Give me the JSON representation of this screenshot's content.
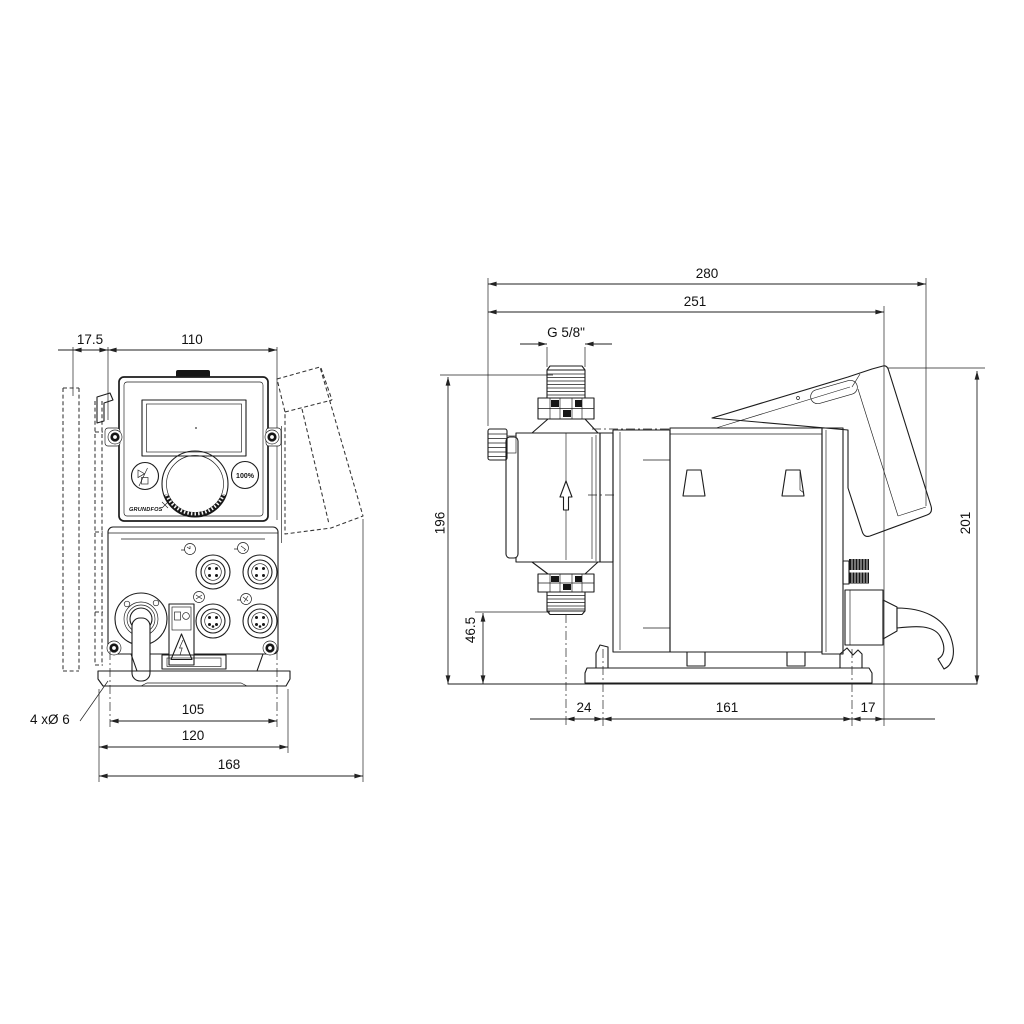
{
  "drawing": {
    "front_view": {
      "dim_offset": "17.5",
      "dim_width": "110",
      "dim_hole_spacing": "105",
      "dim_plate_width": "120",
      "dim_overall_width": "168",
      "mounting_holes_note": "4 xØ 6",
      "panel": {
        "percent_button_label": "100%",
        "brand": "GRUNDFOS"
      }
    },
    "side_view": {
      "dim_overall_length": "280",
      "dim_length": "251",
      "dim_connection_thread": "G 5/8\"",
      "dim_height": "196",
      "dim_clearance": "46.5",
      "dim_rear_height": "201",
      "dim_front_offset": "24",
      "dim_hole_spacing": "161",
      "dim_rear_offset": "17"
    }
  }
}
